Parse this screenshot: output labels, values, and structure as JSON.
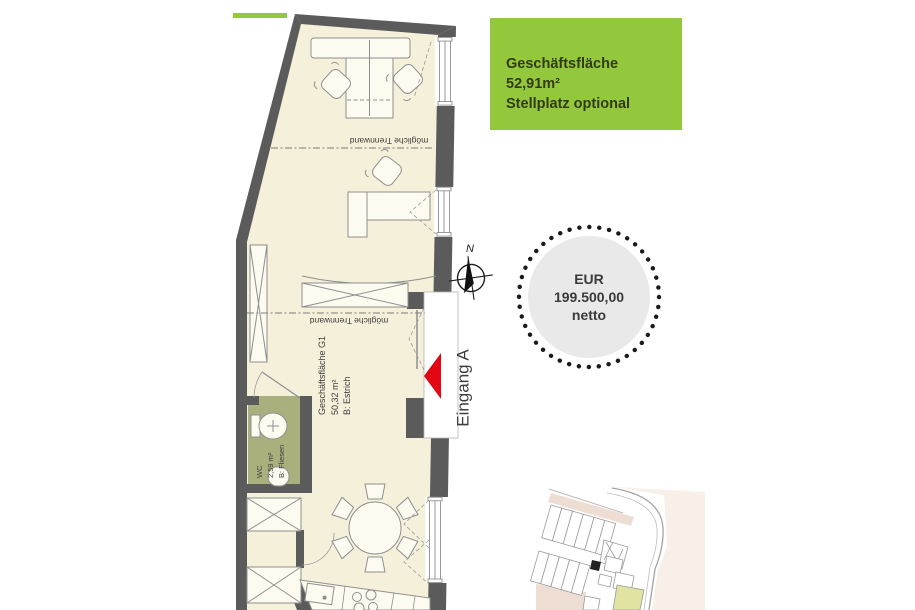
{
  "info_box": {
    "title": "Geschäftsfläche 52,91m²",
    "subtitle": "Stellplatz optional",
    "bg_color": "#93c83d",
    "text_color": "#323a18"
  },
  "price_badge": {
    "currency": "EUR",
    "amount": "199.500,00",
    "tax_note": "netto",
    "fill_color": "#e9e9e9",
    "dot_color": "#1b1b1b"
  },
  "compass": {
    "north_label": "N"
  },
  "floor_plan": {
    "entrance_label": "Eingang A",
    "partition_top_label": "mögliche Trennwand",
    "partition_mid_label": "mögliche Trennwand",
    "rooms": {
      "g1": {
        "name": "Geschäftsfläche G1",
        "area": "50,32 m²",
        "finish": "B: Estrich"
      },
      "wc": {
        "name": "WC",
        "area": "2,59 m²",
        "finish": "B: Fliesen"
      }
    },
    "colors": {
      "wall": "#5b5b5b",
      "floor": "#f5f0da",
      "wc_floor": "#a9b07e",
      "outline": "#8f8f8f",
      "arrow_red": "#e30613",
      "accent_green": "#93c83d"
    }
  }
}
